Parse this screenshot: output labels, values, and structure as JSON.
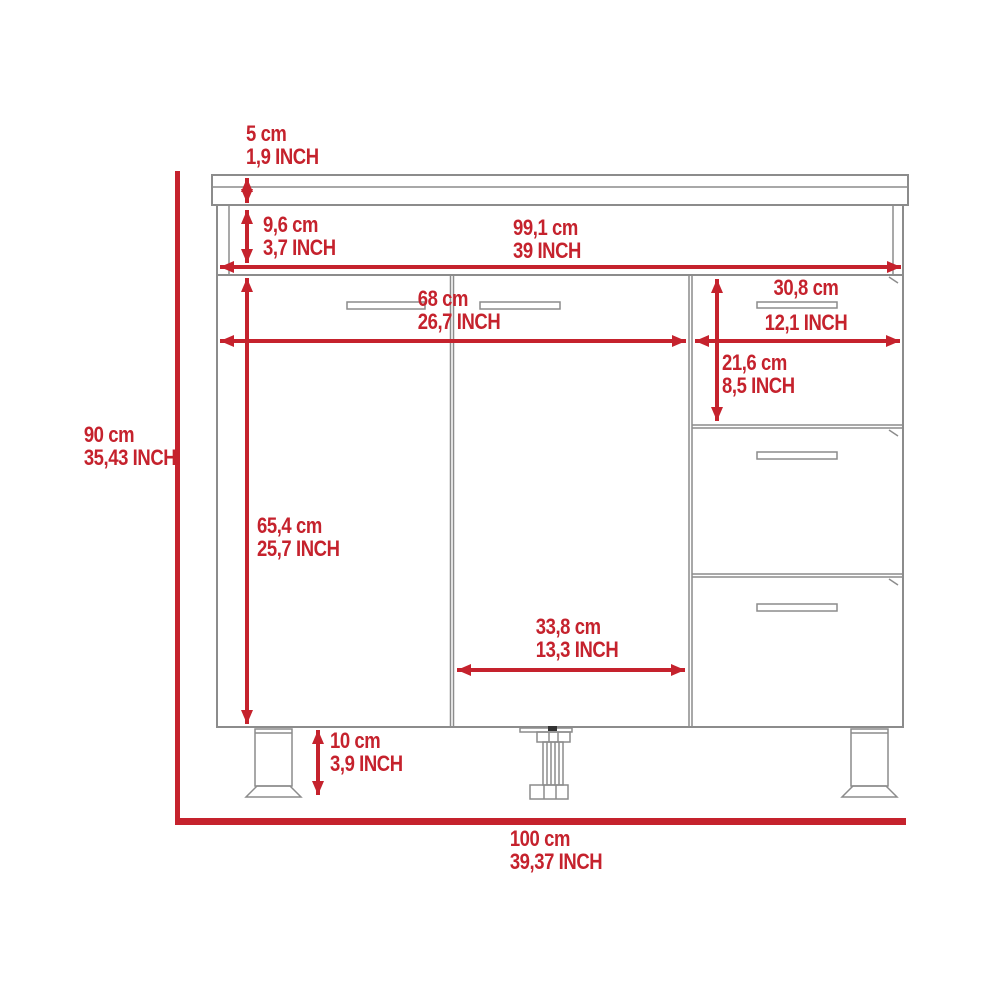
{
  "diagram": {
    "kind": "cabinet-dimension-drawing",
    "units": [
      "cm",
      "INCH"
    ],
    "dimensions": [
      {
        "name": "countertop-thickness",
        "cm": "5 cm",
        "inch": "1,9 INCH"
      },
      {
        "name": "top-rail-height",
        "cm": "9,6 cm",
        "inch": "3,7 INCH"
      },
      {
        "name": "interior-width",
        "cm": "99,1 cm",
        "inch": "39 INCH"
      },
      {
        "name": "double-door-width",
        "cm": "68 cm",
        "inch": "26,7 INCH"
      },
      {
        "name": "drawer-width",
        "cm": "30,8 cm",
        "inch": "12,1 INCH"
      },
      {
        "name": "drawer-front-height",
        "cm": "21,6 cm",
        "inch": "8,5 INCH"
      },
      {
        "name": "overall-height",
        "cm": "90 cm",
        "inch": "35,43 INCH"
      },
      {
        "name": "door-height",
        "cm": "65,4 cm",
        "inch": "25,7 INCH"
      },
      {
        "name": "right-door-width",
        "cm": "33,8 cm",
        "inch": "13,3 INCH"
      },
      {
        "name": "leg-height",
        "cm": "10 cm",
        "inch": "3,9 INCH"
      },
      {
        "name": "overall-width",
        "cm": "100 cm",
        "inch": "39,37 INCH"
      }
    ],
    "colors": {
      "dimension_red": "#C5222D",
      "line_gray": "#8C8C8C",
      "background": "#FFFFFF"
    }
  }
}
